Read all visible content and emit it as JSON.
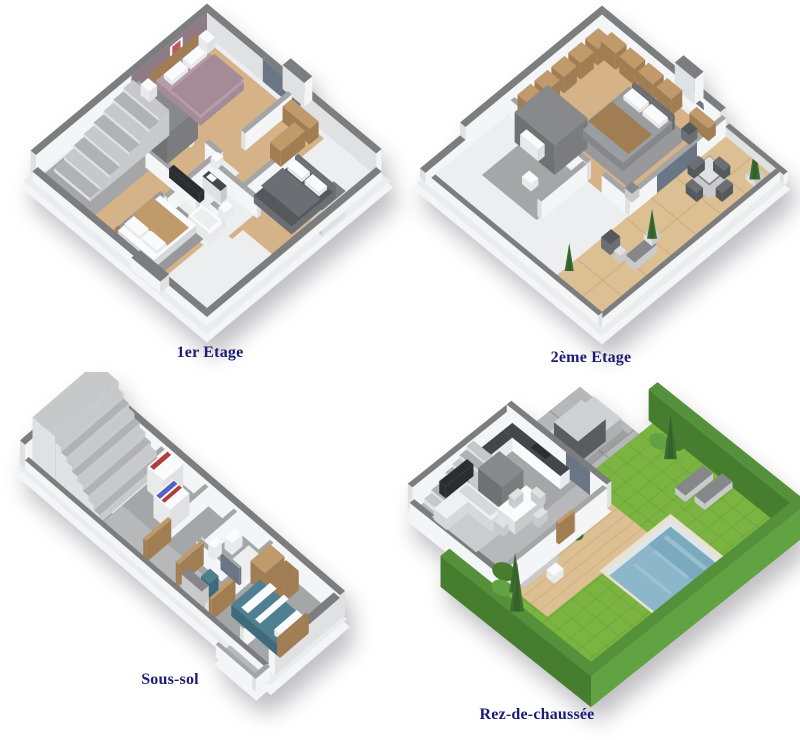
{
  "page": {
    "background": "#ffffff",
    "description": "Sheet of four 3D isometric floor plans of a house"
  },
  "label_style": {
    "color": "#1c1c74"
  },
  "plans": [
    {
      "id": "plan1",
      "label": "1er Etage",
      "features": [
        "bedroom with mauve bed",
        "bedroom with dark grey bed",
        "bedroom with wooden throw bed",
        "bathroom with bathtub",
        "wc",
        "staircase",
        "wardrobes",
        "wood flooring",
        "grey utility block"
      ]
    },
    {
      "id": "plan2",
      "label": "2ème Etage",
      "features": [
        "master bedroom",
        "fitted wooden wardrobes",
        "desk and chair",
        "bathroom",
        "stairwell block",
        "wooden terrace",
        "outdoor dining table with chairs",
        "lounge chairs",
        "cypress trees in planters"
      ]
    },
    {
      "id": "plan3",
      "label": "Sous-sol",
      "features": [
        "staircase",
        "washing machine",
        "dryer",
        "bathroom with shower and toilet",
        "office chair and desk",
        "single bed with teal bedding",
        "wooden wardrobe",
        "concrete floor"
      ]
    },
    {
      "id": "plan4",
      "label": "Rez-de-chaussée",
      "features": [
        "kitchen with dark counters",
        "living room sofa",
        "dining table",
        "staircase",
        "driveway with silver car",
        "wooden deck",
        "outdoor sofa",
        "swimming pool",
        "lawn",
        "hedge border",
        "sun loungers",
        "cypress trees"
      ]
    }
  ],
  "palette": {
    "pageBg": "#ffffff",
    "labelColor": "#1c1c74",
    "ww": "#f4f5f6",
    "ws": "#dfe1e3",
    "wd": "#c8cacc",
    "wt": "#7b7d7f",
    "wt2": "#a3a5a7",
    "slab": "#ebecee",
    "wood": "#d5b287",
    "wood2": "#c4a071",
    "terrace": "#dcc094",
    "terraceLine": "#c8a97c",
    "tile": "#eceeef",
    "grayFloor": "#a4a6a8",
    "grayFloor2": "#b6b8ba",
    "rug": "#97999b",
    "rugLight": "#cbcdcf",
    "stepA": "#b0b2b4",
    "stepB": "#c6c8ca",
    "mauve": "#8f7a86",
    "mauveBed": "#b49ca8",
    "mauveBed2": "#a48b97",
    "darkBed": "#55585c",
    "darkBed2": "#6b6e72",
    "bedGray": "#9b9ea1",
    "white": "#fafbfc",
    "white2": "#e8eaec",
    "woodFurn": "#c09a6a",
    "woodFurn2": "#a07d52",
    "glass": "#6b7684",
    "counter": "#43464a",
    "black": "#2b2d30",
    "teal": "#4f7f90",
    "tealDark": "#3f6a79",
    "tableGray": "#85878a",
    "red": "#b13d3f",
    "blue": "#5561c6",
    "grass": "#7cb442",
    "grassLine": "#69a135",
    "hedge": "#55903a",
    "hedgeDark": "#477d2f",
    "hedge2": "#61a242",
    "tree": "#3c6e30",
    "treeDark": "#2f5826",
    "pool": "#8cb7ca",
    "poolDeep": "#74a4ba",
    "poolWall": "#dfe6e9",
    "poolLight": "#aacbd9",
    "coping": "#e9e2d1",
    "paver": "#b5b7b9",
    "paverLine": "#97999b",
    "car": "#cfd1d3",
    "car2": "#aeb0b2",
    "carWin": "#5a5d60",
    "sofa": "#eef0f2",
    "sofaShade": "#d6d9db",
    "block": "#6f7173",
    "block2": "#87898b",
    "block3": "#7a7c7e",
    "artRed": "#b85c5e"
  }
}
